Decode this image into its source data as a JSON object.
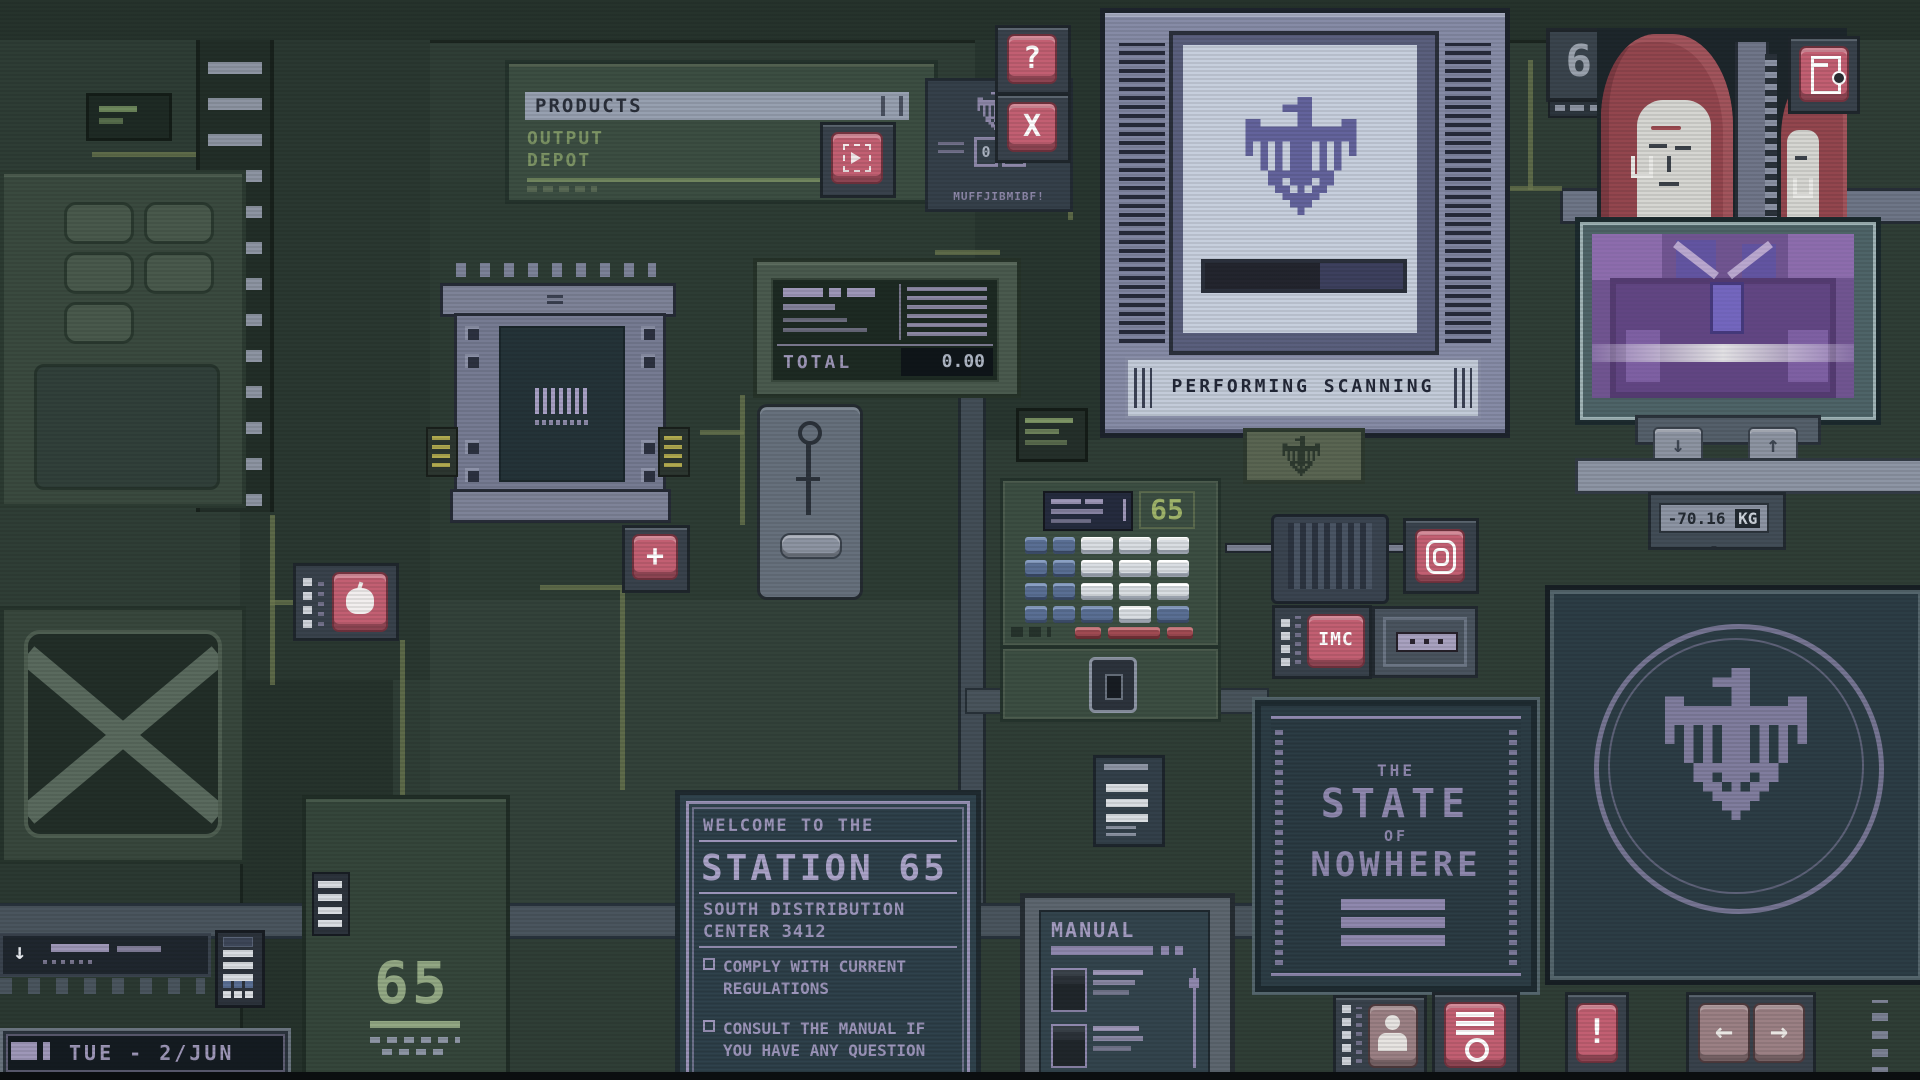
{
  "colors": {
    "accent_pink": "#c25f72",
    "screen_blue": "#c7cfdd",
    "panel_green": "#3c4e42",
    "text_purple": "#9c95ba",
    "text_green": "#7d9465",
    "key_blue": "#5a6f94",
    "key_red": "#a04a52",
    "progress_navy": "#3d405e"
  },
  "products_panel": {
    "header": "PRODUCTS",
    "line1": "OUTPUT",
    "line2": "DEPOT"
  },
  "info_panel": {
    "counter_left": "0",
    "counter_right": "0",
    "code": "MUFFJIBMIBF!"
  },
  "window_controls": {
    "help": "?",
    "close": "X"
  },
  "scanner": {
    "status": "PERFORMING SCANNING",
    "progress_percent": 58
  },
  "station_id_top": "65",
  "xray": {
    "weight": "70.16",
    "unit": "KG",
    "dash": "-",
    "down": "↓",
    "up": "↑"
  },
  "register": {
    "total_label": "TOTAL",
    "total_value": "0.00"
  },
  "keypad_unit": {
    "station_id": "65"
  },
  "imc_label": "IMC",
  "poster": {
    "the": "THE",
    "state": "STATE",
    "of": "OF",
    "nowhere": "NOWHERE"
  },
  "welcome_sign": {
    "intro": "WELCOME TO THE",
    "title": "STATION 65",
    "sub1": "SOUTH DISTRIBUTION",
    "sub2": "CENTER 3412",
    "rules": [
      "COMPLY WITH CURRENT REGULATIONS",
      "CONSULT THE MANUAL IF YOU HAVE ANY QUESTION"
    ]
  },
  "manual_panel": {
    "title": "MANUAL"
  },
  "plate_id": "65",
  "date_display": "TUE - 2/JUN",
  "controls": {
    "plus": "+",
    "exclaim": "!",
    "left": "←",
    "right": "→",
    "down": "↓"
  }
}
